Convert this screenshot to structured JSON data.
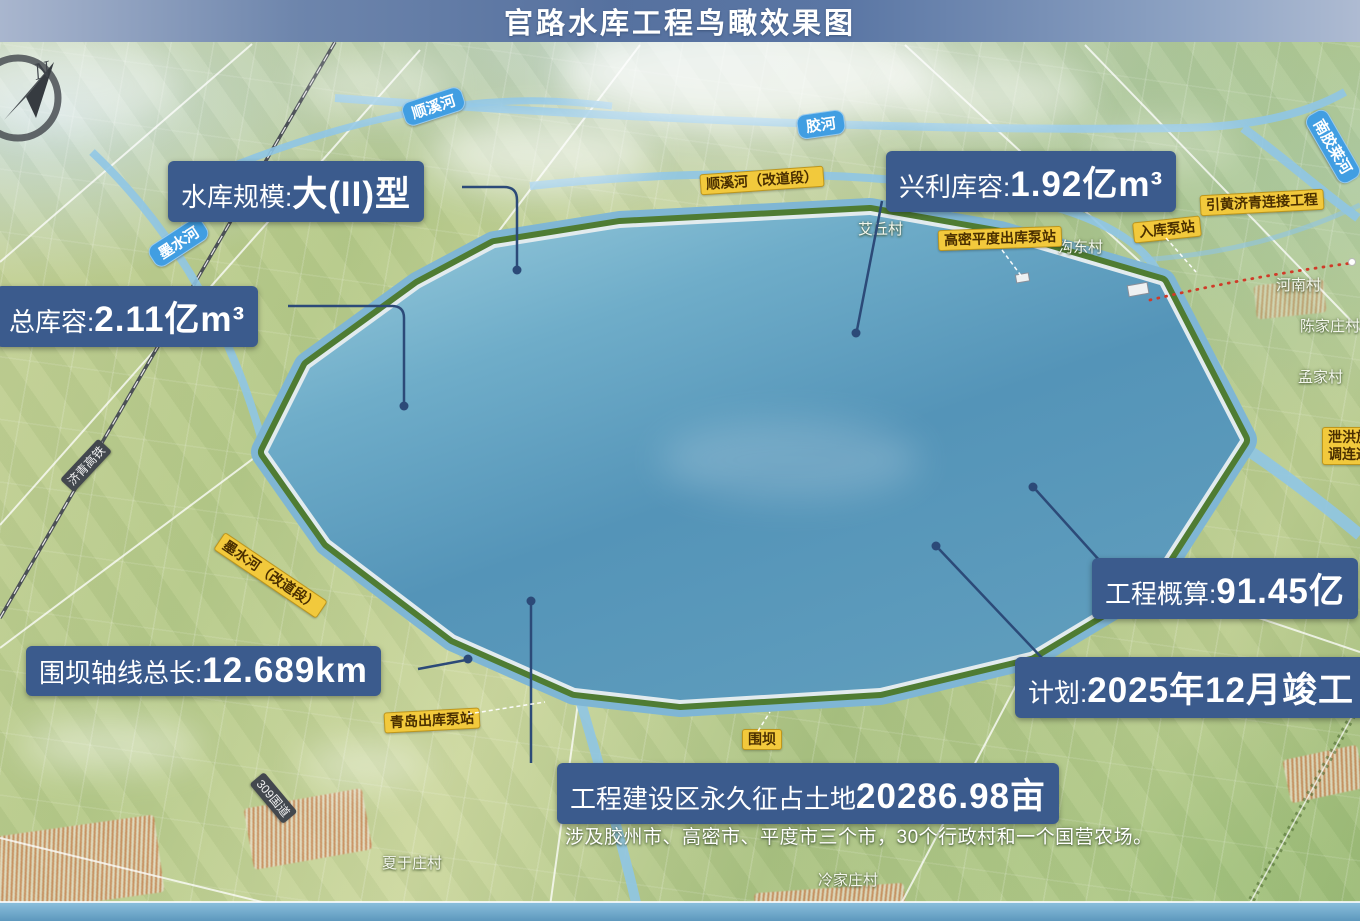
{
  "title": "官路水库工程鸟瞰效果图",
  "compass_n": "N",
  "callouts": {
    "scale": {
      "label": "水库规模:",
      "value": "大(II)型"
    },
    "total_capacity": {
      "label": "总库容:",
      "value": "2.11亿m³"
    },
    "beneficial_capacity": {
      "label": "兴利库容:",
      "value": "1.92亿m³"
    },
    "dam_axis_length": {
      "label": "围坝轴线总长:",
      "value": "12.689km"
    },
    "estimate": {
      "label": "工程概算:",
      "value": "91.45亿"
    },
    "plan": {
      "label": "计划:",
      "value": "2025年12月竣工"
    },
    "land": {
      "label": "工程建设区永久征占土地",
      "value": "20286.98亩"
    },
    "land_note": "涉及胶州市、高密市、平度市三个市，30个行政村和一个国营农场。"
  },
  "map_labels": {
    "rivers": {
      "shunxi_river": "顺溪河",
      "jiao_river": "胶河",
      "nanjiaolai_river": "南胶莱河",
      "moshui_river": "墨水河"
    },
    "roads": {
      "jiqing_rail": "济青高铁",
      "g309": "309国道"
    },
    "facilities": {
      "shunxi_diversion": "顺溪河（改道段）",
      "yellow_river_connect": "引黄济青连接工程",
      "gaomi_pingdu_pump": "高密平度出库泵站",
      "inlet_pump": "入库泵站",
      "spillway_line1": "泄洪放",
      "spillway_line2": "调连通",
      "moshui_diversion": "墨水河（改道段）",
      "qingdao_pump": "青岛出库泵站",
      "dam": "围坝"
    },
    "villages": {
      "aiqiu": "艾丘村",
      "goudong": "沟东村",
      "henan": "河南村",
      "chenjiazhuang": "陈家庄村",
      "mengjia": "孟家村",
      "xiayuzhuang": "夏于庄村",
      "lengjiazhuang": "冷家庄村"
    }
  },
  "colors": {
    "callout_bg": "#3b5b8d",
    "label_yellow": "#f2c93c",
    "river_label_blue": "#419ee2",
    "water_blue": "#5796ba",
    "title_bar_blue": "#56719f"
  }
}
